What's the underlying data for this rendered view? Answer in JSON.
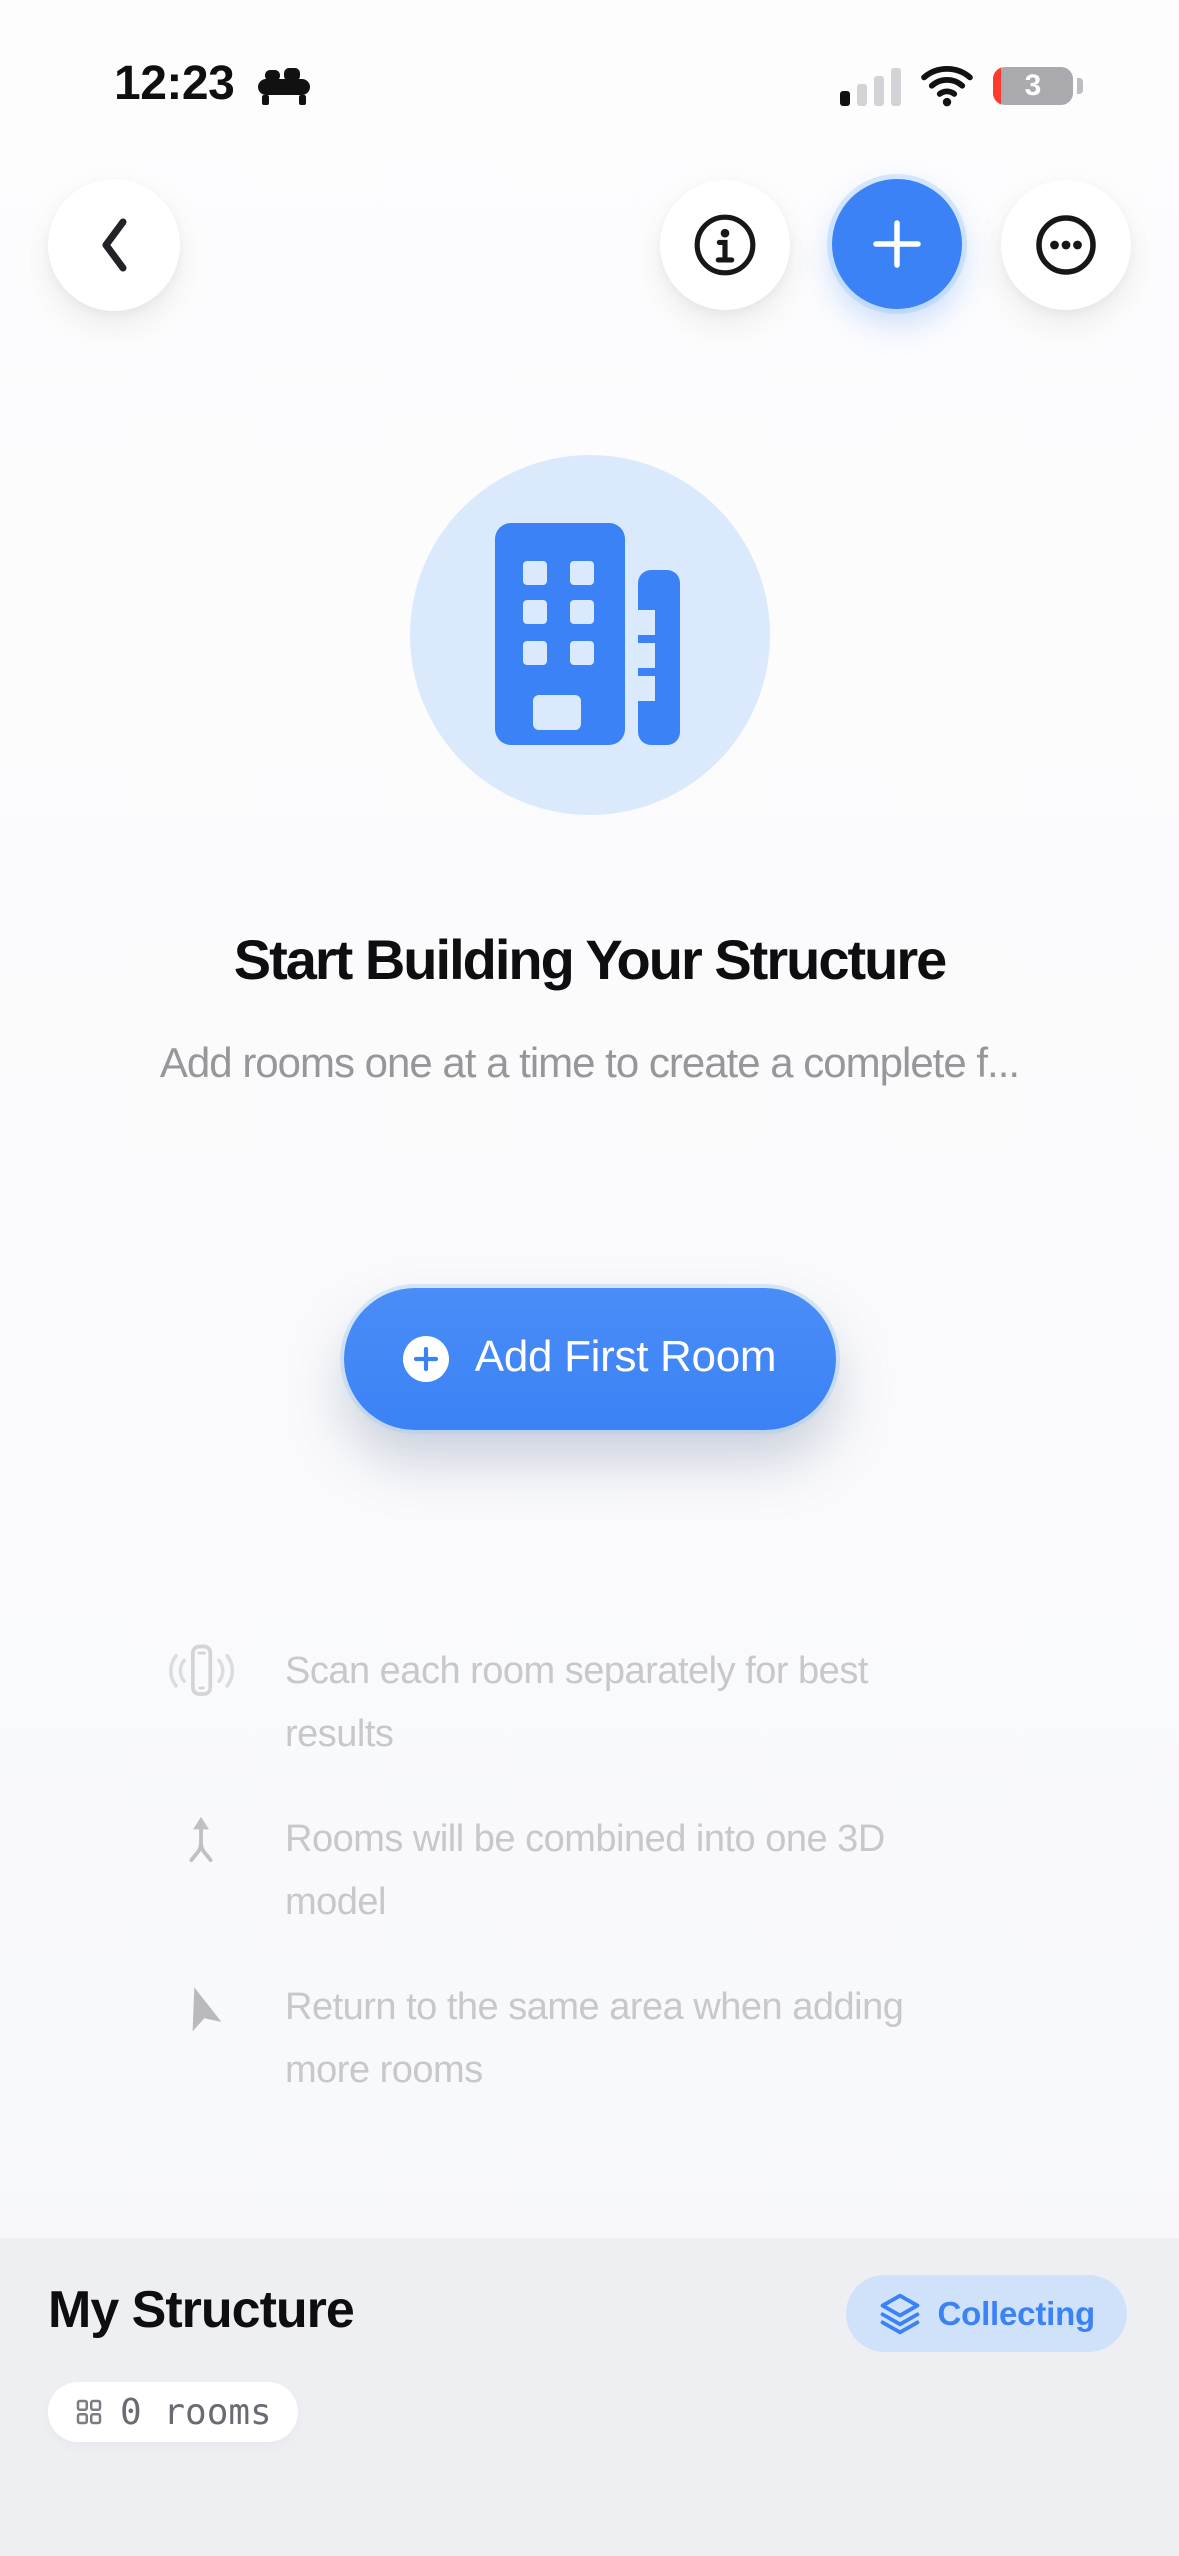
{
  "status_bar": {
    "time": "12:23",
    "battery_level": "3"
  },
  "hero": {
    "title": "Start Building Your Structure",
    "subtitle": "Add rooms one at a time to create a complete f...",
    "primary_button_label": "Add First Room"
  },
  "hints": {
    "items": [
      {
        "icon": "phone-vibrate-icon",
        "text": "Scan each room separately for best results"
      },
      {
        "icon": "merge-arrow-icon",
        "text": "Rooms will be combined into one 3D model"
      },
      {
        "icon": "location-arrow-icon",
        "text": "Return to the same area when adding more rooms"
      }
    ]
  },
  "footer": {
    "title": "My Structure",
    "status_badge_label": "Collecting",
    "rooms_count_label": "0 rooms"
  },
  "colors": {
    "accent_blue": "#3b82f6",
    "hero_circle_blue": "#dbe9fd",
    "badge_bg": "#d0e2fa",
    "footer_bg": "#edeff3",
    "battery_red": "#ff3b30",
    "muted_gray": "#c7c7cc"
  }
}
